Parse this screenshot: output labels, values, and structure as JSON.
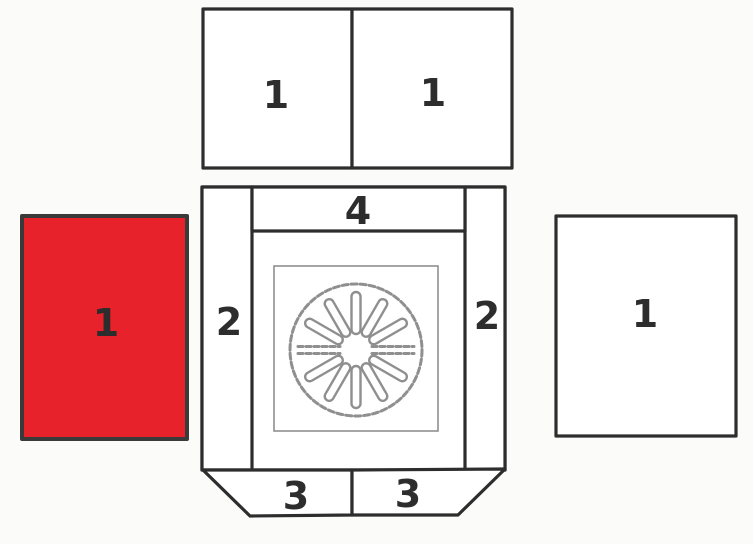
{
  "colors": {
    "highlight_red": "#e8222a",
    "line_dark": "#2d2d2d",
    "sketch_gray": "#8f8f8f",
    "background": "#fbfbfa"
  },
  "parts": {
    "top_plate_left": {
      "label": "1"
    },
    "top_plate_right": {
      "label": "1"
    },
    "left_brick": {
      "label": "1",
      "highlighted": true
    },
    "right_brick": {
      "label": "1"
    },
    "side_left": {
      "label": "2"
    },
    "side_right": {
      "label": "2"
    },
    "rear_plate": {
      "label": "4"
    },
    "bottom_left": {
      "label": "3"
    },
    "bottom_right": {
      "label": "3"
    },
    "grate": {
      "label": ""
    }
  }
}
